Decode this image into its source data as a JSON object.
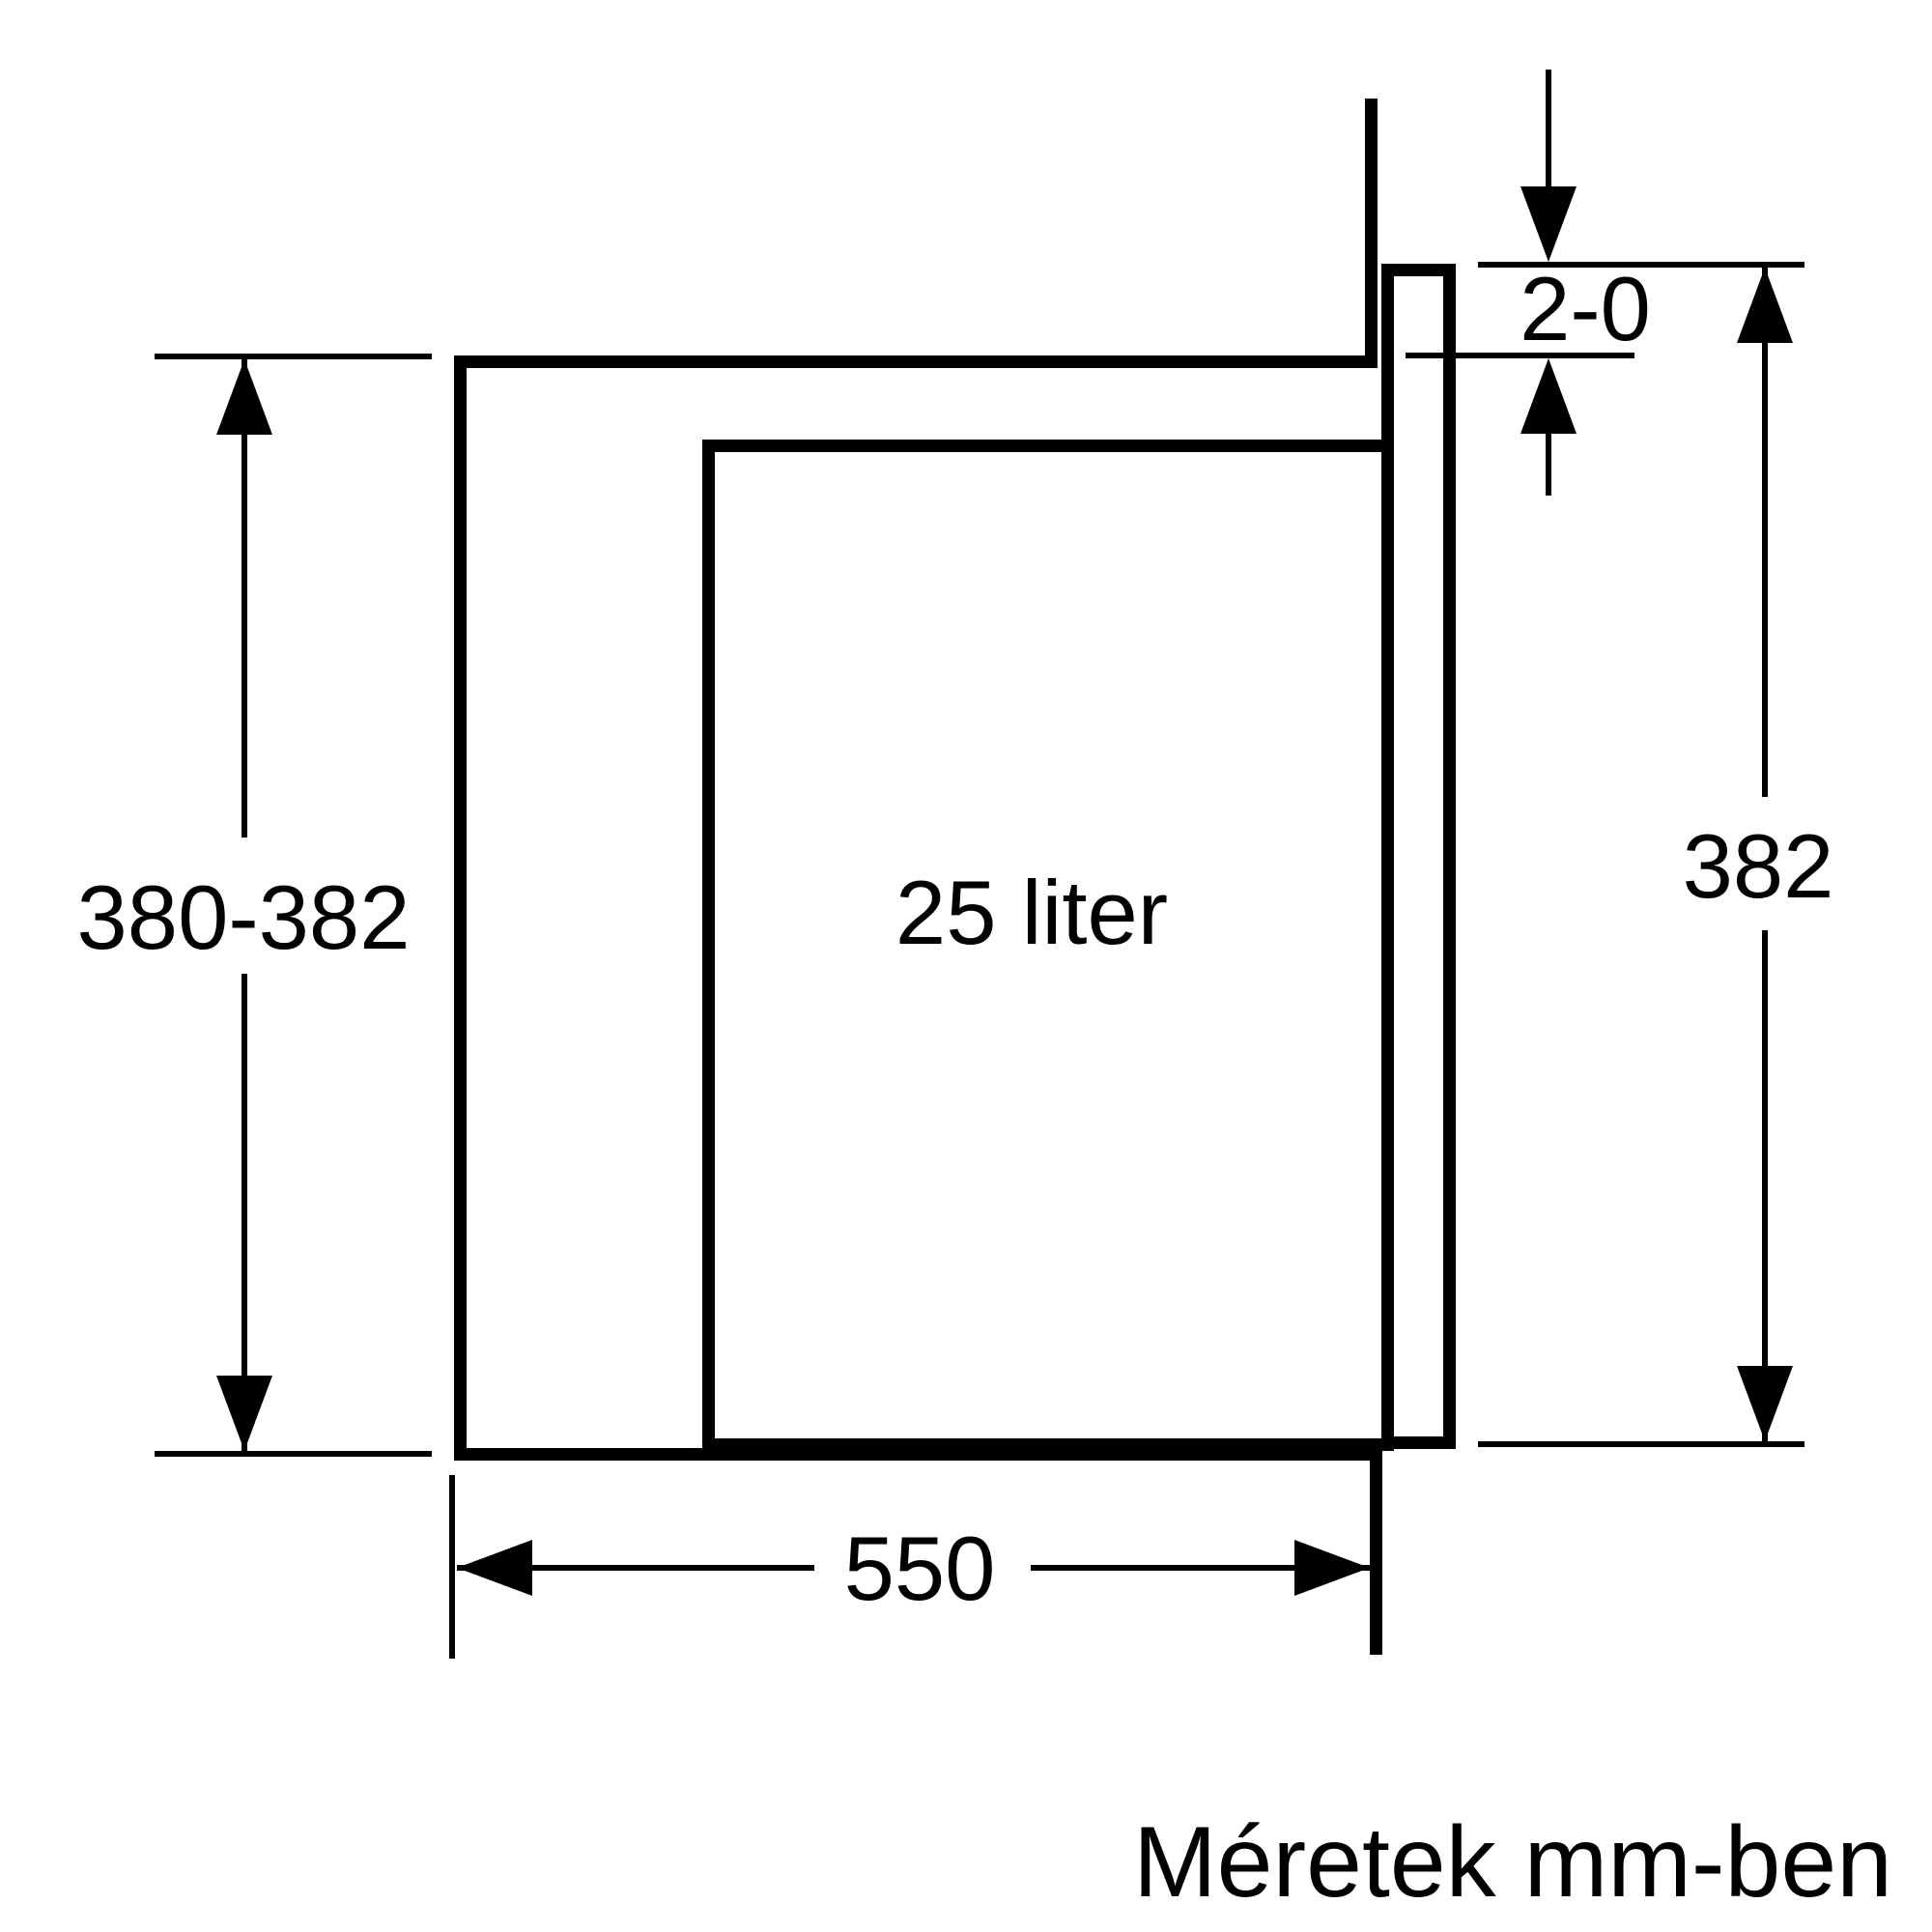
{
  "diagram": {
    "labels": {
      "niche_height": "380-382",
      "top_gap": "2-0",
      "appliance_height": "382",
      "capacity": "25 liter",
      "niche_width": "550",
      "note": "Méretek mm-ben"
    },
    "colors": {
      "line": "#000000",
      "background": "#ffffff"
    }
  }
}
